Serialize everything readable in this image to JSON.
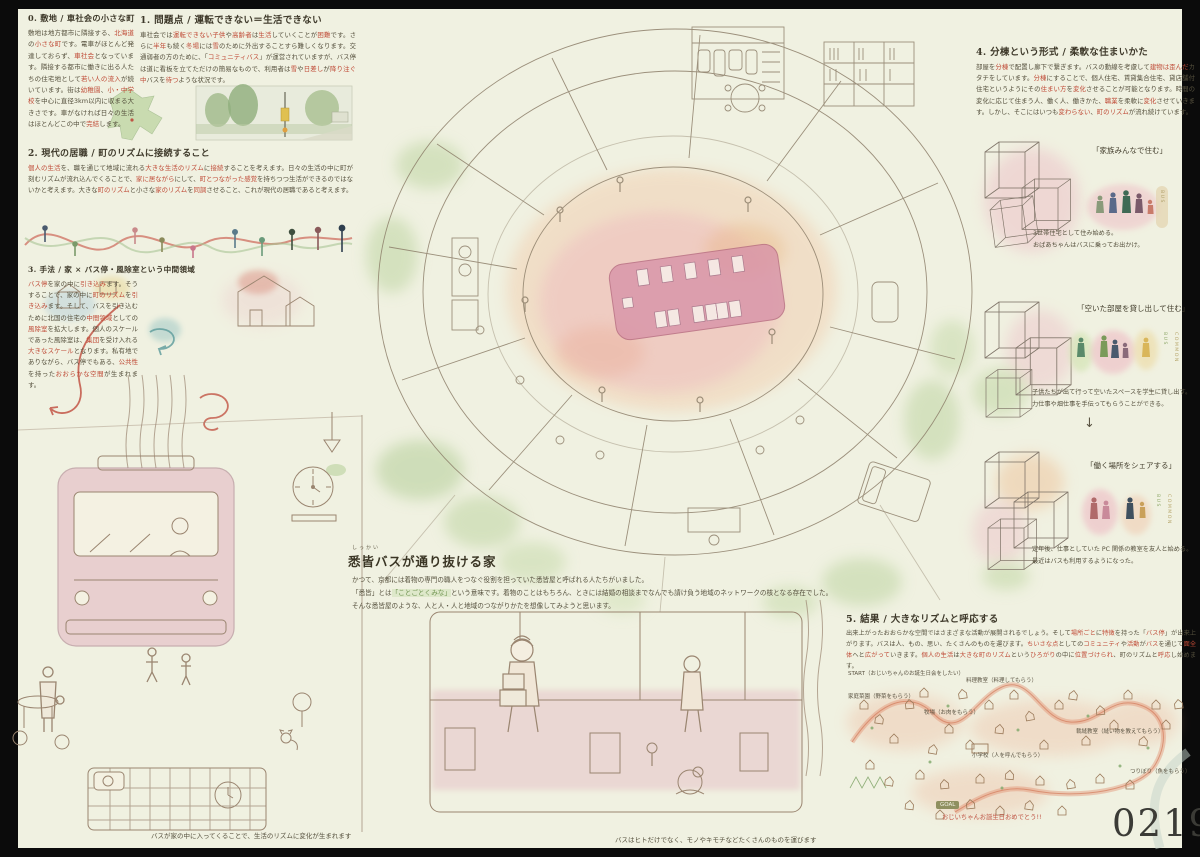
{
  "meta": {
    "id_number": "0219"
  },
  "sections": [
    {
      "heading": "0. 敷地 / 車社会の小さな町",
      "body": [
        {
          "t": "敷地は地方都市に隣接する、"
        },
        {
          "t": "北海道",
          "c": "r"
        },
        {
          "t": "の"
        },
        {
          "t": "小さな町",
          "c": "r"
        },
        {
          "t": "です。電車がほとんど発達しておらず、"
        },
        {
          "t": "車社会",
          "c": "r"
        },
        {
          "t": "となっています。隣接する都市に働きに出る人たちの住宅地として"
        },
        {
          "t": "若い人の流入",
          "c": "r"
        },
        {
          "t": "が続いています。街は"
        },
        {
          "t": "幼稚園",
          "c": "r"
        },
        {
          "t": "、"
        },
        {
          "t": "小・中学校",
          "c": "r"
        },
        {
          "t": "を中心に直径3km以内に収まる大きさです。車がなければ日々の生活はほとんどこの中で"
        },
        {
          "t": "完結",
          "c": "r"
        },
        {
          "t": "します。"
        }
      ]
    },
    {
      "heading": "1. 問題点 / 運転できない＝生活できない",
      "body": [
        {
          "t": "車社会では"
        },
        {
          "t": "運転できない子供",
          "c": "r"
        },
        {
          "t": "や"
        },
        {
          "t": "高齢者",
          "c": "r"
        },
        {
          "t": "は"
        },
        {
          "t": "生活",
          "c": "r"
        },
        {
          "t": "していくことが"
        },
        {
          "t": "困難",
          "c": "r"
        },
        {
          "t": "です。さらに"
        },
        {
          "t": "半年",
          "c": "r"
        },
        {
          "t": "も続く"
        },
        {
          "t": "冬場",
          "c": "r"
        },
        {
          "t": "には"
        },
        {
          "t": "雪",
          "c": "r"
        },
        {
          "t": "のために外出することすら難しくなります。交通弱者の方のために、「"
        },
        {
          "t": "コミュニティバス",
          "c": "r"
        },
        {
          "t": "」が運営されていますが、バス停は道に看板を立てただけの簡易なもので、利用者は"
        },
        {
          "t": "雪",
          "c": "r"
        },
        {
          "t": "や"
        },
        {
          "t": "日差し",
          "c": "r"
        },
        {
          "t": "が"
        },
        {
          "t": "降り注ぐ中",
          "c": "r"
        },
        {
          "t": "バスを"
        },
        {
          "t": "待つ",
          "c": "r"
        },
        {
          "t": "ような状況です。"
        }
      ]
    },
    {
      "heading": "2. 現代の居職 / 町のリズムに接続すること",
      "body": [
        {
          "t": "個人の生活",
          "c": "r"
        },
        {
          "t": "を、職を通じて地域に流れる"
        },
        {
          "t": "大きな生活のリズム",
          "c": "r"
        },
        {
          "t": "に"
        },
        {
          "t": "接続",
          "c": "r"
        },
        {
          "t": "することを考えます。日々の生活の中に町が刻むリズムが流れ込んでくることで、"
        },
        {
          "t": "家に居ながら",
          "c": "r"
        },
        {
          "t": "にして、"
        },
        {
          "t": "町とつながった感覚",
          "c": "r"
        },
        {
          "t": "を持ちつつ生活ができるのではないかと考えます。大きな"
        },
        {
          "t": "町のリズム",
          "c": "r"
        },
        {
          "t": "と小さな"
        },
        {
          "t": "家のリズム",
          "c": "r"
        },
        {
          "t": "を"
        },
        {
          "t": "同調",
          "c": "r"
        },
        {
          "t": "させること、これが現代の居職であると考えます。"
        }
      ]
    },
    {
      "heading": "3. 手法 / 家 × バス停・風除室という中間領域",
      "body": [
        {
          "t": "バス停",
          "c": "r"
        },
        {
          "t": "を家の中に"
        },
        {
          "t": "引き込み",
          "c": "r"
        },
        {
          "t": "ます。そうすることで、家の中に"
        },
        {
          "t": "町のリズム",
          "c": "r"
        },
        {
          "t": "を"
        },
        {
          "t": "引き込み",
          "c": "r"
        },
        {
          "t": "ます。そして、バスを引き込むために北国の住宅の"
        },
        {
          "t": "中間領域",
          "c": "r"
        },
        {
          "t": "としての"
        },
        {
          "t": "風除室",
          "c": "r"
        },
        {
          "t": "を拡大します。個人のスケールであった風除室は、"
        },
        {
          "t": "集団",
          "c": "r"
        },
        {
          "t": "を受け入れる"
        },
        {
          "t": "大きなスケール",
          "c": "r"
        },
        {
          "t": "となります。私有地でありながら、バス停でもある、"
        },
        {
          "t": "公共性",
          "c": "r"
        },
        {
          "t": "を持った"
        },
        {
          "t": "おおらかな空間",
          "c": "r"
        },
        {
          "t": "が生まれます。"
        }
      ]
    },
    {
      "heading": "4. 分棟という形式 / 柔軟な住まいかた",
      "body": [
        {
          "t": "部屋を"
        },
        {
          "t": "分棟",
          "c": "r"
        },
        {
          "t": "で配置し廊下で繋ぎます。バスの動線を考慮して"
        },
        {
          "t": "建物は歪んだ",
          "c": "r"
        },
        {
          "t": "カタチをしています。"
        },
        {
          "t": "分棟",
          "c": "r"
        },
        {
          "t": "にすることで、個人住宅、賃貸集合住宅、貸店舗付住宅というようにその"
        },
        {
          "t": "住まい方",
          "c": "r"
        },
        {
          "t": "を"
        },
        {
          "t": "変化",
          "c": "r"
        },
        {
          "t": "させることが可能となります。時間の変化に応じて住まう人、働く人、働きかた、"
        },
        {
          "t": "職業",
          "c": "r"
        },
        {
          "t": "を柔軟に"
        },
        {
          "t": "変化",
          "c": "r"
        },
        {
          "t": "させていきます。しかし、そこにはいつも"
        },
        {
          "t": "変わらない",
          "c": "r"
        },
        {
          "t": "、"
        },
        {
          "t": "町のリズム",
          "c": "r"
        },
        {
          "t": "が流れ続けています。"
        }
      ]
    },
    {
      "heading": "5. 結果 / 大きなリズムと呼応する",
      "body": [
        {
          "t": "出来上がったおおらかな空間ではさまざまな活動が展開されるでしょう。そして"
        },
        {
          "t": "場所ごと",
          "c": "r"
        },
        {
          "t": "に"
        },
        {
          "t": "特徴",
          "c": "r"
        },
        {
          "t": "を持った「"
        },
        {
          "t": "バス停",
          "c": "r"
        },
        {
          "t": "」が出来上がります。バスは人、もの、思い、たくさんのものを運びます。"
        },
        {
          "t": "ちいさな点",
          "c": "r"
        },
        {
          "t": "としての"
        },
        {
          "t": "コミュニティ",
          "c": "r"
        },
        {
          "t": "や"
        },
        {
          "t": "活動",
          "c": "r"
        },
        {
          "t": "が"
        },
        {
          "t": "バス",
          "c": "r"
        },
        {
          "t": "を通じて"
        },
        {
          "t": "面全体",
          "c": "r"
        },
        {
          "t": "へと"
        },
        {
          "t": "広がって",
          "c": "r"
        },
        {
          "t": "いきます。"
        },
        {
          "t": "個人の生活",
          "c": "r"
        },
        {
          "t": "は"
        },
        {
          "t": "大きな町のリズム",
          "c": "r"
        },
        {
          "t": "という"
        },
        {
          "t": "ひろがり",
          "c": "r"
        },
        {
          "t": "の中に"
        },
        {
          "t": "位置づけられ",
          "c": "r"
        },
        {
          "t": "、町のリズムと"
        },
        {
          "t": "呼応",
          "c": "r"
        },
        {
          "t": "し始めます。"
        }
      ]
    }
  ],
  "title_block": {
    "furigana": "しっかい",
    "title": "悉皆バスが通り抜ける家",
    "lines": [
      [
        {
          "t": "かつて、京都には着物の専門の職人をつなぐ役割を担っていた悉皆屋と呼ばれる人たちがいました。"
        }
      ],
      [
        {
          "t": "「悉皆」とは"
        },
        {
          "t": "「ことごとくみな」",
          "c": "g"
        },
        {
          "t": "という意味です。着物のことはもちろん、ときには結婚の相談までなんでも請け負う地域のネットワークの核となる存在でした。"
        }
      ],
      [
        {
          "t": "そんな悉皆屋のような、人と人・人と地域のつながりかたを想像してみようと思います。"
        }
      ]
    ]
  },
  "scenarios": [
    {
      "label": "「家族みんなで住む」",
      "caption_lines": [
        "3世帯住宅として住み始める。",
        "おばあちゃんはバスに乗ってお出かけ。"
      ],
      "tags": [
        "BUS"
      ]
    },
    {
      "label": "「空いた部屋を貸し出して住む」",
      "caption_lines": [
        "子供たちが出て行って空いたスペースを学生に貸し出す。",
        "力仕事や畑仕事を手伝ってもらうことができる。"
      ],
      "tags": [
        "BUS",
        "COMMON"
      ]
    },
    {
      "label": "「働く場所をシェアする」",
      "caption_lines": [
        "定年後、仕事としていた PC 関係の教室を友人と始める。",
        "最近はバスも利用するようになった。"
      ],
      "tags": [
        "BUS",
        "COMMON"
      ]
    }
  ],
  "arrow_down": "↓",
  "map": {
    "labels": [
      "START（おじいちゃんのお誕生日会をしたい）",
      "料理教室（料理してもらう）",
      "家庭菜園（野菜をもらう）",
      "牧場（お肉をもらう）",
      "裁縫教室（縫い物を教えてもらう）",
      "小学校（人を呼んでもらう）",
      "つりぼり（魚をもらう）"
    ],
    "goal_badge": "GOAL",
    "goal_text": "おじいちゃんお誕生日おめでとう!!"
  },
  "captions": {
    "left": "バスが家の中に入ってくることで、生活のリズムに変化が生まれます",
    "center": "バスはヒトだけでなく、モノやキモチなどたくさんのものを運びます"
  },
  "colors": {
    "paper": "#f0f1e1",
    "ink": "#55503d",
    "accent_red": "#bf4a36",
    "pink": "#e3a9ba",
    "green": "#b9d29c",
    "orange": "#eec29a",
    "line": "#9a8570"
  }
}
